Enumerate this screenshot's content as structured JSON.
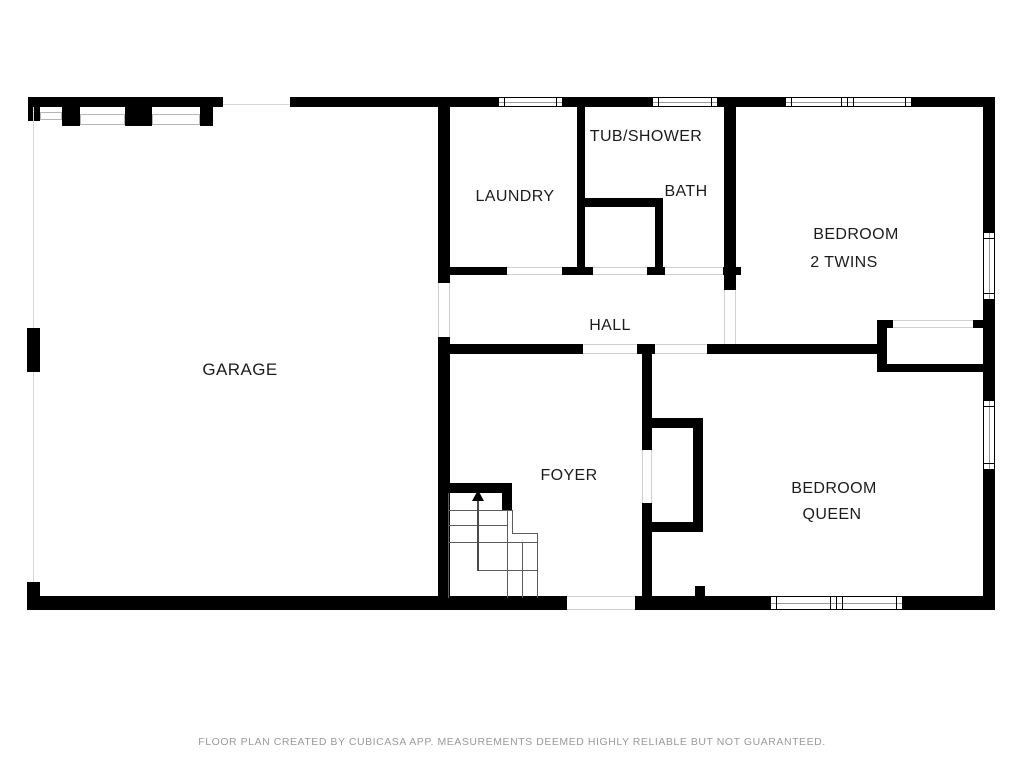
{
  "floor_plan": {
    "rooms": {
      "garage": {
        "label": "GARAGE"
      },
      "laundry": {
        "label": "LAUNDRY"
      },
      "tub_shower": {
        "label": "TUB/SHOWER"
      },
      "bath": {
        "label": "BATH"
      },
      "bedroom_twins": {
        "label": "BEDROOM",
        "sublabel": "2 TWINS"
      },
      "hall": {
        "label": "HALL"
      },
      "foyer": {
        "label": "FOYER"
      },
      "bedroom_queen": {
        "label": "BEDROOM",
        "sublabel": "QUEEN"
      }
    },
    "colors": {
      "wall": "#000000",
      "background": "#ffffff",
      "opening_line": "#d0d0d0",
      "stair_line": "#5c5c5c",
      "footer_text": "#9a9a9a"
    }
  },
  "footer": {
    "disclaimer": "FLOOR PLAN CREATED BY CUBICASA APP. MEASUREMENTS DEEMED HIGHLY RELIABLE BUT NOT GUARANTEED."
  }
}
